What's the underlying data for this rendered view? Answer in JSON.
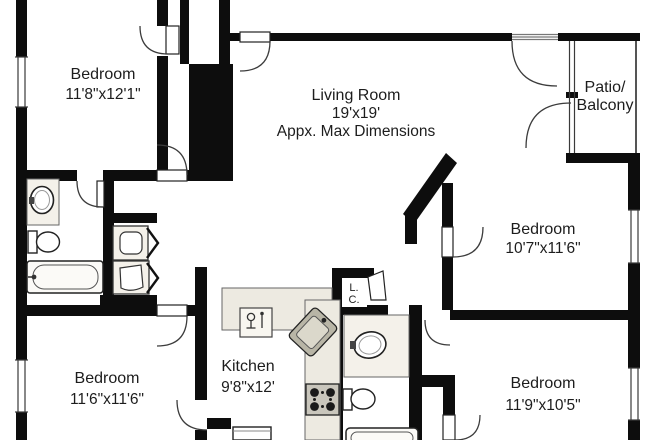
{
  "title": "Apartment floor plan",
  "colors": {
    "wall": "#0d0d0d",
    "background": "#ffffff",
    "fixture_fill": "#f4f1ea",
    "counter_fill": "#edeae1",
    "appliance_dark": "#c9c6bc",
    "text": "#1d1d1d"
  },
  "rooms": {
    "bedroom_top_left": {
      "name": "Bedroom",
      "dims": "11'8\"x12'1\""
    },
    "living_room": {
      "name": "Living Room",
      "dims": "19'x19'",
      "note": "Appx. Max Dimensions"
    },
    "patio": {
      "line1": "Patio/",
      "line2": "Balcony"
    },
    "bedroom_right": {
      "name": "Bedroom",
      "dims": "10'7\"x11'6\""
    },
    "kitchen": {
      "name": "Kitchen",
      "dims": "9'8\"x12'"
    },
    "bedroom_bottom_left": {
      "name": "Bedroom",
      "dims": "11'6\"x11'6\""
    },
    "bedroom_bottom_right": {
      "name": "Bedroom",
      "dims": "11'9\"x10'5\""
    },
    "linen_closet": {
      "line1": "L.",
      "line2": "C."
    }
  },
  "fixtures": [
    "bathtub",
    "toilet",
    "vanity-sink",
    "washer",
    "dryer",
    "bifold-doors",
    "dishwasher",
    "kitchen-corner-sink",
    "stove",
    "refrigerator",
    "sliding-glass-door",
    "windows",
    "door-swings"
  ]
}
